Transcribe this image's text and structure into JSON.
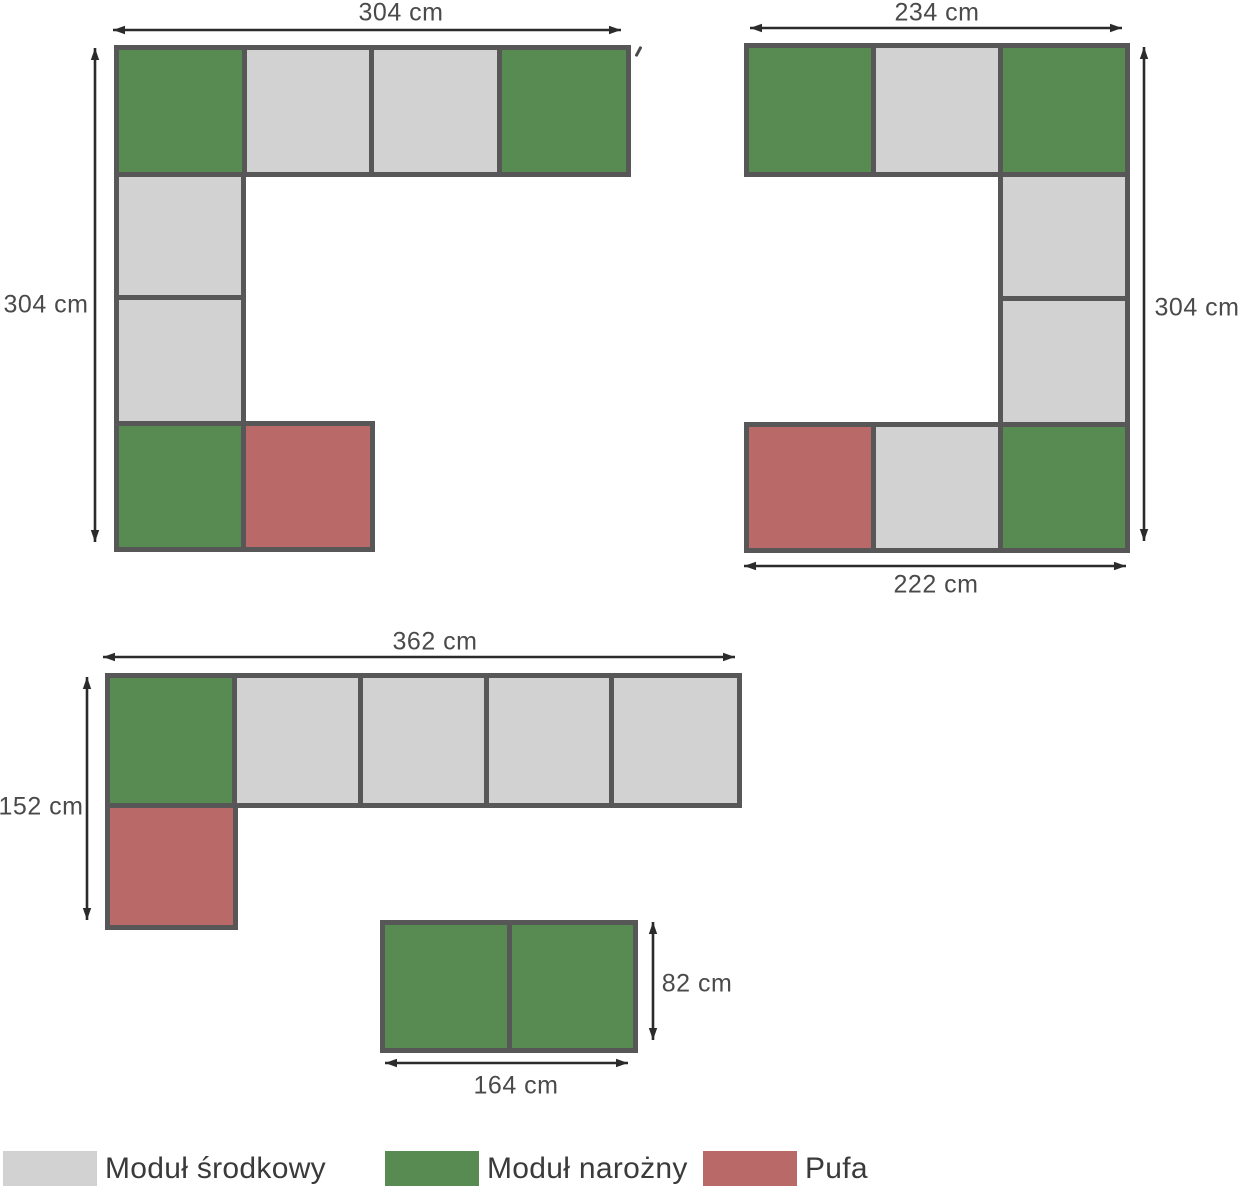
{
  "colors": {
    "background": "#ffffff",
    "module_center": "#d2d2d2",
    "module_corner": "#588b52",
    "pufa": "#ba6969",
    "outline": "#575757",
    "arrow": "#2b2b2b",
    "dimension_text": "#4a4a4a",
    "legend_text": "#3a3a3a"
  },
  "legend": {
    "items": [
      {
        "type": "center",
        "label": "Moduł środkowy"
      },
      {
        "type": "corner",
        "label": "Moduł narożny"
      },
      {
        "type": "pufa",
        "label": "Pufa"
      }
    ]
  },
  "diagrams": [
    {
      "id": "corner-sofa-304x304",
      "cells": [
        {
          "x1": 114,
          "y1": 45,
          "x2": 242,
          "y2": 172,
          "type": "corner"
        },
        {
          "x1": 242,
          "y1": 45,
          "x2": 369,
          "y2": 172,
          "type": "center"
        },
        {
          "x1": 369,
          "y1": 45,
          "x2": 497,
          "y2": 172,
          "type": "center"
        },
        {
          "x1": 497,
          "y1": 45,
          "x2": 626,
          "y2": 172,
          "type": "corner"
        },
        {
          "x1": 114,
          "y1": 172,
          "x2": 241,
          "y2": 295,
          "type": "center"
        },
        {
          "x1": 114,
          "y1": 295,
          "x2": 241,
          "y2": 421,
          "type": "center"
        },
        {
          "x1": 114,
          "y1": 421,
          "x2": 241,
          "y2": 547,
          "type": "corner"
        },
        {
          "x1": 241,
          "y1": 421,
          "x2": 370,
          "y2": 547,
          "type": "pufa"
        }
      ],
      "arrows": [
        {
          "x1": 113,
          "y1": 30,
          "x2": 621,
          "y2": 30
        },
        {
          "x1": 95,
          "y1": 48,
          "x2": 95,
          "y2": 542
        }
      ],
      "labels": [
        {
          "name": "width",
          "text": "304 cm",
          "cx": 401,
          "cy": 13
        },
        {
          "name": "height",
          "text": "304 cm",
          "cx": 46,
          "cy": 305
        }
      ]
    },
    {
      "id": "corner-sofa-234x304",
      "cells": [
        {
          "x1": 744,
          "y1": 43,
          "x2": 871,
          "y2": 172,
          "type": "corner"
        },
        {
          "x1": 871,
          "y1": 43,
          "x2": 998,
          "y2": 172,
          "type": "center"
        },
        {
          "x1": 998,
          "y1": 43,
          "x2": 1125,
          "y2": 172,
          "type": "corner"
        },
        {
          "x1": 998,
          "y1": 172,
          "x2": 1125,
          "y2": 296,
          "type": "center"
        },
        {
          "x1": 998,
          "y1": 296,
          "x2": 1125,
          "y2": 422,
          "type": "center"
        },
        {
          "x1": 744,
          "y1": 422,
          "x2": 871,
          "y2": 548,
          "type": "pufa"
        },
        {
          "x1": 871,
          "y1": 422,
          "x2": 998,
          "y2": 548,
          "type": "center"
        },
        {
          "x1": 998,
          "y1": 422,
          "x2": 1125,
          "y2": 548,
          "type": "corner"
        }
      ],
      "arrows": [
        {
          "x1": 750,
          "y1": 28,
          "x2": 1122,
          "y2": 28
        },
        {
          "x1": 1144,
          "y1": 47,
          "x2": 1144,
          "y2": 541
        },
        {
          "x1": 744,
          "y1": 566,
          "x2": 1126,
          "y2": 566
        }
      ],
      "labels": [
        {
          "name": "top-width",
          "text": "234 cm",
          "cx": 937,
          "cy": 13
        },
        {
          "name": "height",
          "text": "304 cm",
          "cx": 1197,
          "cy": 308
        },
        {
          "name": "bottom-width",
          "text": "222 cm",
          "cx": 936,
          "cy": 585
        }
      ]
    },
    {
      "id": "l-sofa-362x152",
      "cells": [
        {
          "x1": 105,
          "y1": 673,
          "x2": 232,
          "y2": 803,
          "type": "corner"
        },
        {
          "x1": 232,
          "y1": 673,
          "x2": 358,
          "y2": 803,
          "type": "center"
        },
        {
          "x1": 358,
          "y1": 673,
          "x2": 484,
          "y2": 803,
          "type": "center"
        },
        {
          "x1": 484,
          "y1": 673,
          "x2": 609,
          "y2": 803,
          "type": "center"
        },
        {
          "x1": 609,
          "y1": 673,
          "x2": 737,
          "y2": 803,
          "type": "center"
        },
        {
          "x1": 105,
          "y1": 803,
          "x2": 233,
          "y2": 925,
          "type": "pufa"
        }
      ],
      "arrows": [
        {
          "x1": 103,
          "y1": 657,
          "x2": 735,
          "y2": 657
        },
        {
          "x1": 87,
          "y1": 677,
          "x2": 87,
          "y2": 920
        }
      ],
      "labels": [
        {
          "name": "width",
          "text": "362 cm",
          "cx": 435,
          "cy": 642
        },
        {
          "name": "height",
          "text": "152 cm",
          "cx": 41,
          "cy": 807
        }
      ]
    },
    {
      "id": "bench-164x82",
      "cells": [
        {
          "x1": 380,
          "y1": 920,
          "x2": 507,
          "y2": 1048,
          "type": "corner"
        },
        {
          "x1": 507,
          "y1": 920,
          "x2": 633,
          "y2": 1048,
          "type": "corner"
        }
      ],
      "arrows": [
        {
          "x1": 653,
          "y1": 922,
          "x2": 653,
          "y2": 1040
        },
        {
          "x1": 385,
          "y1": 1063,
          "x2": 628,
          "y2": 1063
        }
      ],
      "labels": [
        {
          "name": "height",
          "text": "82 cm",
          "cx": 697,
          "cy": 984
        },
        {
          "name": "width",
          "text": "164 cm",
          "cx": 516,
          "cy": 1086
        }
      ]
    }
  ],
  "legend_layout": {
    "swatch_positions": [
      3,
      385,
      703
    ]
  }
}
